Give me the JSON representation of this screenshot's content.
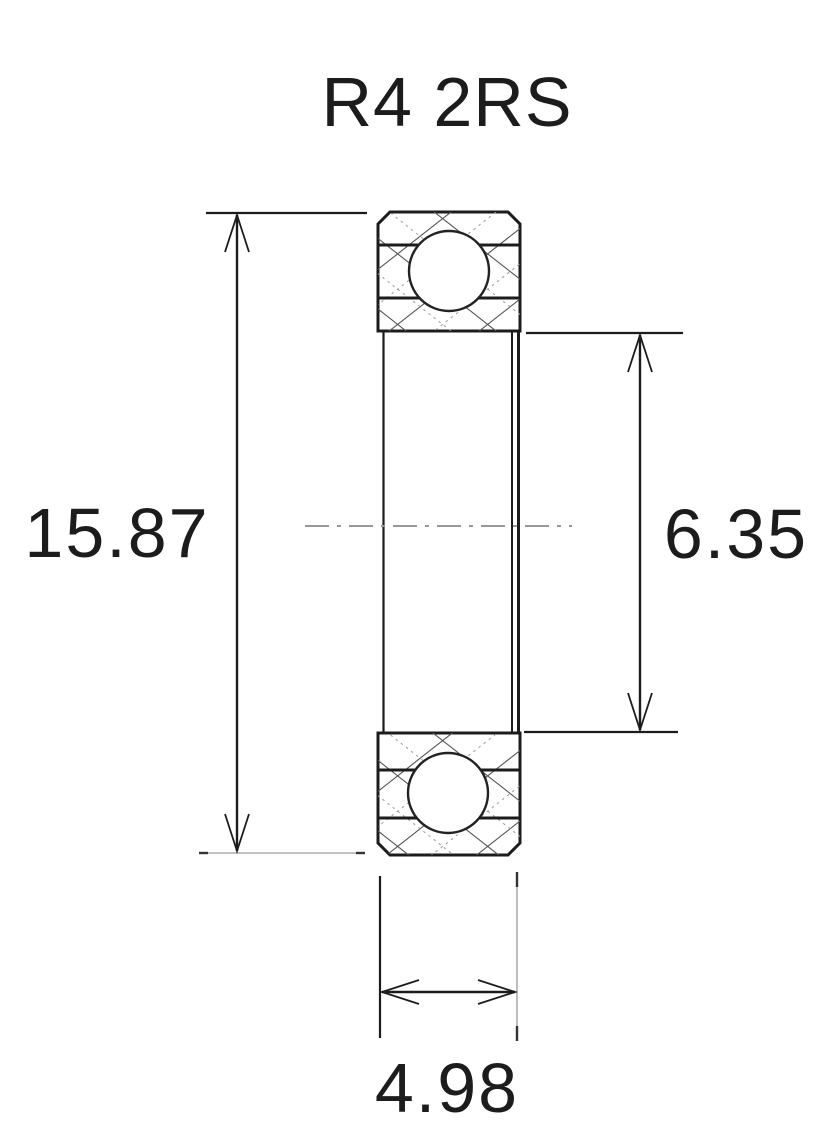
{
  "drawing": {
    "title": "R4 2RS",
    "dimensions": {
      "outer_diameter": {
        "value": "15.87",
        "side": "left"
      },
      "bore_diameter": {
        "value": "6.35",
        "side": "right"
      },
      "width": {
        "value": "4.98",
        "side": "bottom"
      }
    },
    "colors": {
      "line": "#1c1c1c",
      "background": "#ffffff",
      "centerline": "#989898",
      "hatch": "#555555"
    }
  }
}
